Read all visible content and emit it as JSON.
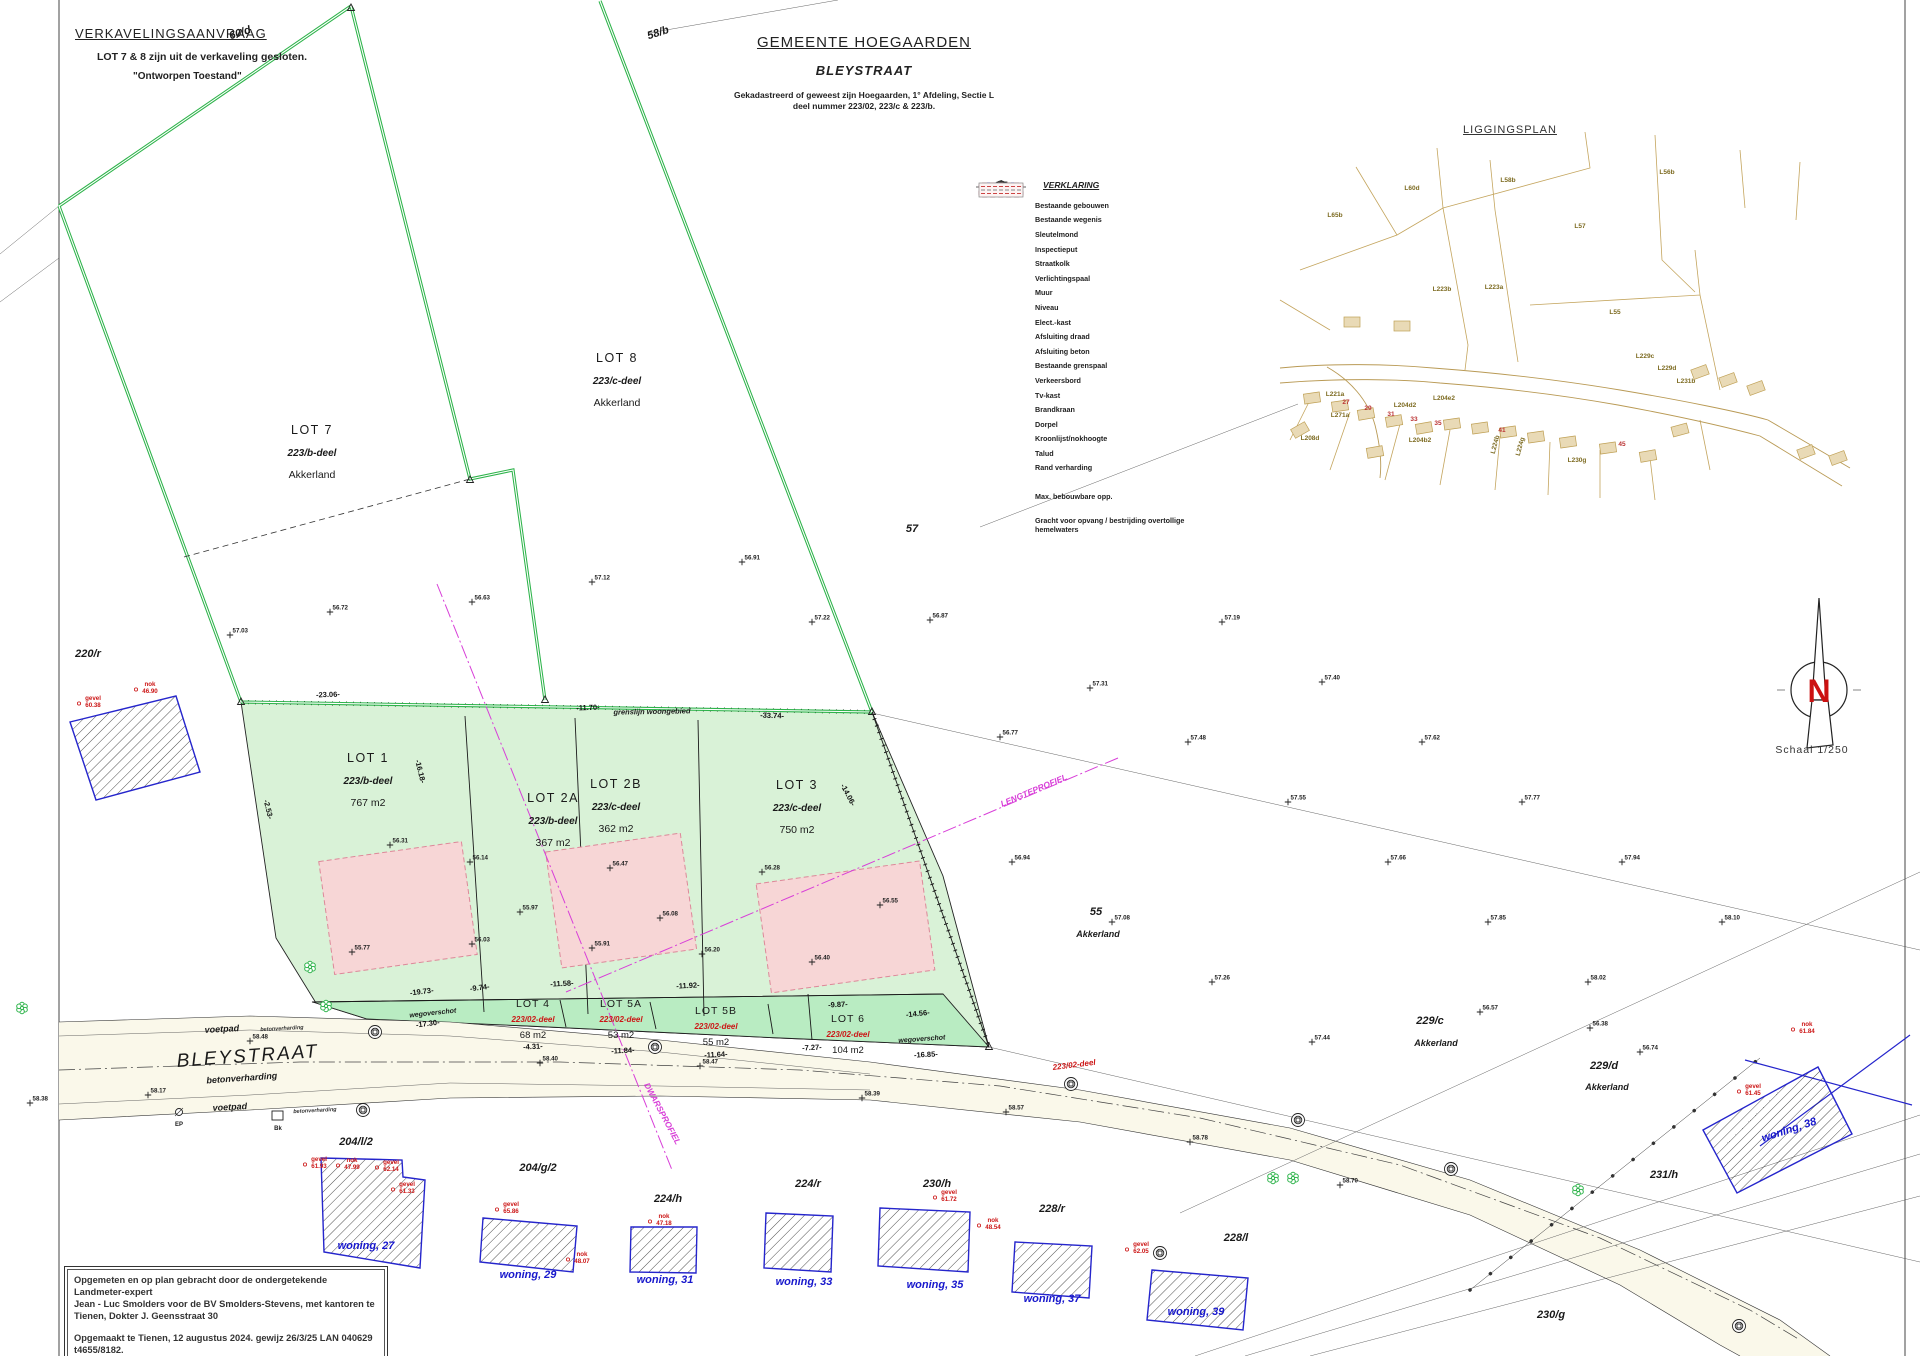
{
  "header": {
    "title": "VERKAVELINGSAANVRAAG",
    "note": "LOT 7 & 8 zijn uit de verkaveling gesloten.",
    "state": "\"Ontworpen Toestand\""
  },
  "title_block": {
    "municipality": "GEMEENTE HOEGAARDEN",
    "street": "BLEYSTRAAT",
    "cadastre1": "Gekadastreerd of geweest zijn Hoegaarden, 1° Afdeling, Sectie L",
    "cadastre2": "deel nummer 223/02, 223/c & 223/b."
  },
  "legend": {
    "title": "VERKLARING",
    "items": [
      {
        "label": "Bestaande gebouwen"
      },
      {
        "label": "Bestaande wegenis"
      },
      {
        "label": "Sleutelmond"
      },
      {
        "label": "Inspectieput"
      },
      {
        "label": "Straatkolk"
      },
      {
        "label": "Verlichtingspaal"
      },
      {
        "label": "Muur"
      },
      {
        "label": "Niveau",
        "value": "10.63"
      },
      {
        "label": "Elect.-kast"
      },
      {
        "label": "Afsluiting draad"
      },
      {
        "label": "Afsluiting beton"
      },
      {
        "label": "Bestaande grenspaal"
      },
      {
        "label": "Verkeersbord"
      },
      {
        "label": "Tv-kast"
      },
      {
        "label": "Brandkraan"
      },
      {
        "label": "Dorpel"
      },
      {
        "label": "Kroonlijst/nokhoogte"
      },
      {
        "label": "Talud"
      },
      {
        "label": "Rand verharding"
      },
      {
        "label": "Max. bebouwbare opp."
      },
      {
        "label": "Gracht voor opvang / bestrijding overtollige hemelwaters"
      }
    ]
  },
  "liggingsplan": {
    "title": "LIGGINGSPLAN",
    "labels": [
      {
        "t": "L60d",
        "x": 1412,
        "y": 190
      },
      {
        "t": "L58b",
        "x": 1508,
        "y": 182
      },
      {
        "t": "L56b",
        "x": 1667,
        "y": 174
      },
      {
        "t": "L57",
        "x": 1580,
        "y": 228
      },
      {
        "t": "L65b",
        "x": 1335,
        "y": 217
      },
      {
        "t": "L223b",
        "x": 1442,
        "y": 291
      },
      {
        "t": "L223a",
        "x": 1494,
        "y": 289
      },
      {
        "t": "L55",
        "x": 1615,
        "y": 314
      },
      {
        "t": "L229c",
        "x": 1645,
        "y": 358
      },
      {
        "t": "L229d",
        "x": 1667,
        "y": 370
      },
      {
        "t": "L231b",
        "x": 1686,
        "y": 383
      },
      {
        "t": "L221a",
        "x": 1335,
        "y": 396
      },
      {
        "t": "L271a",
        "x": 1340,
        "y": 417
      },
      {
        "t": "L204d2",
        "x": 1405,
        "y": 407
      },
      {
        "t": "L204e2",
        "x": 1444,
        "y": 400
      },
      {
        "t": "L204b2",
        "x": 1420,
        "y": 442
      },
      {
        "t": "L224b",
        "x": 1497,
        "y": 445,
        "r": -75
      },
      {
        "t": "L224g",
        "x": 1522,
        "y": 447,
        "r": -75
      },
      {
        "t": "L230g",
        "x": 1577,
        "y": 462
      },
      {
        "t": "L208d",
        "x": 1310,
        "y": 440
      },
      {
        "t": "27",
        "x": 1346,
        "y": 404,
        "cls": "lgr"
      },
      {
        "t": "29",
        "x": 1368,
        "y": 410,
        "cls": "lgr"
      },
      {
        "t": "31",
        "x": 1391,
        "y": 416,
        "cls": "lgr"
      },
      {
        "t": "33",
        "x": 1414,
        "y": 421,
        "cls": "lgr"
      },
      {
        "t": "35",
        "x": 1438,
        "y": 425,
        "cls": "lgr"
      },
      {
        "t": "41",
        "x": 1502,
        "y": 432,
        "cls": "lgr"
      },
      {
        "t": "45",
        "x": 1622,
        "y": 446,
        "cls": "lgr"
      }
    ],
    "buildings": [
      {
        "x": 1312,
        "y": 398,
        "r": -8
      },
      {
        "x": 1340,
        "y": 406,
        "r": -8
      },
      {
        "x": 1366,
        "y": 414,
        "r": -10
      },
      {
        "x": 1394,
        "y": 421,
        "r": -10
      },
      {
        "x": 1424,
        "y": 428,
        "r": -10
      },
      {
        "x": 1452,
        "y": 424,
        "r": -8
      },
      {
        "x": 1480,
        "y": 428,
        "r": -8
      },
      {
        "x": 1508,
        "y": 432,
        "r": -8
      },
      {
        "x": 1536,
        "y": 437,
        "r": -8
      },
      {
        "x": 1568,
        "y": 442,
        "r": -8
      },
      {
        "x": 1608,
        "y": 448,
        "r": -8
      },
      {
        "x": 1648,
        "y": 456,
        "r": -10
      },
      {
        "x": 1700,
        "y": 372,
        "r": -20
      },
      {
        "x": 1728,
        "y": 380,
        "r": -20
      },
      {
        "x": 1756,
        "y": 388,
        "r": -20
      },
      {
        "x": 1806,
        "y": 452,
        "r": -20
      },
      {
        "x": 1838,
        "y": 458,
        "r": -20
      },
      {
        "x": 1352,
        "y": 322,
        "r": 0
      },
      {
        "x": 1402,
        "y": 326,
        "r": 0
      },
      {
        "x": 1300,
        "y": 430,
        "r": -30
      },
      {
        "x": 1375,
        "y": 452,
        "r": -10
      },
      {
        "x": 1680,
        "y": 430,
        "r": -15
      }
    ]
  },
  "north": {
    "label": "N",
    "scale": "Schaal  1/250"
  },
  "attribution": {
    "lines": [
      "Opgemeten en op plan gebracht door de ondergetekende Landmeter-expert",
      "Jean - Luc Smolders voor de BV Smolders-Stevens, met kantoren te",
      "Tienen, Dokter J. Geensstraat 30",
      "Opgemaakt te Tienen, 12 augustus 2024. gewijz 26/3/25  LAN 040629   t4655/8182."
    ]
  },
  "map": {
    "lots_big": [
      {
        "name": "LOT 7",
        "deel": "223/b-deel",
        "info": "Akkerland",
        "x": 312,
        "y": 434
      },
      {
        "name": "LOT 8",
        "deel": "223/c-deel",
        "info": "Akkerland",
        "x": 617,
        "y": 362
      },
      {
        "name": "LOT 1",
        "deel": "223/b-deel",
        "info": "767 m2",
        "x": 368,
        "y": 762
      },
      {
        "name": "LOT 2A",
        "deel": "223/b-deel",
        "info": "367 m2",
        "x": 553,
        "y": 802
      },
      {
        "name": "LOT 2B",
        "deel": "223/c-deel",
        "info": "362 m2",
        "x": 616,
        "y": 788
      },
      {
        "name": "LOT 3",
        "deel": "223/c-deel",
        "info": "750 m2",
        "x": 797,
        "y": 789
      }
    ],
    "lots_small": [
      {
        "name": "LOT 4",
        "deel": "223/02-deel",
        "info": "68 m2",
        "x": 533,
        "y": 1007
      },
      {
        "name": "LOT 5A",
        "deel": "223/02-deel",
        "info": "53 m2",
        "x": 621,
        "y": 1007
      },
      {
        "name": "LOT 5B",
        "deel": "223/02-deel",
        "info": "55 m2",
        "x": 716,
        "y": 1014
      },
      {
        "name": "LOT 6",
        "deel": "223/02-deel",
        "info": "104 m2",
        "x": 848,
        "y": 1022
      }
    ],
    "labels": [
      {
        "t": "60/d",
        "x": 241,
        "y": 36,
        "r": -18
      },
      {
        "t": "58/b",
        "x": 659,
        "y": 36,
        "r": -18
      },
      {
        "t": "57",
        "x": 912,
        "y": 532
      },
      {
        "t": "220/r",
        "x": 88,
        "y": 657
      },
      {
        "t": "55",
        "x": 1096,
        "y": 915
      },
      {
        "t": "Akkerland",
        "x": 1098,
        "y": 937,
        "cls": "tl2"
      },
      {
        "t": "229/c",
        "x": 1430,
        "y": 1024
      },
      {
        "t": "Akkerland",
        "x": 1436,
        "y": 1046,
        "cls": "tl2"
      },
      {
        "t": "229/d",
        "x": 1604,
        "y": 1069
      },
      {
        "t": "Akkerland",
        "x": 1607,
        "y": 1090,
        "cls": "tl2"
      },
      {
        "t": "231/h",
        "x": 1664,
        "y": 1178
      },
      {
        "t": "204/l/2",
        "x": 356,
        "y": 1145
      },
      {
        "t": "204/g/2",
        "x": 538,
        "y": 1171
      },
      {
        "t": "224/h",
        "x": 668,
        "y": 1202
      },
      {
        "t": "224/r",
        "x": 808,
        "y": 1187
      },
      {
        "t": "230/h",
        "x": 937,
        "y": 1187
      },
      {
        "t": "228/r",
        "x": 1052,
        "y": 1212
      },
      {
        "t": "228/l",
        "x": 1236,
        "y": 1241
      },
      {
        "t": "230/g",
        "x": 1551,
        "y": 1318
      },
      {
        "t": "grenslijn woongebied",
        "x": 652,
        "y": 714,
        "r": -1,
        "cls": "tlsm"
      },
      {
        "t": "wegoverschot",
        "x": 433,
        "y": 1015,
        "r": -6,
        "cls": "wov"
      },
      {
        "t": "wegoverschot",
        "x": 922,
        "y": 1041,
        "r": -4,
        "cls": "wov"
      },
      {
        "t": "voetpad",
        "x": 222,
        "y": 1032,
        "r": -3,
        "cls": "st2"
      },
      {
        "t": "BLEYSTRAAT",
        "x": 248,
        "y": 1062,
        "r": -4,
        "cls": "stbig"
      },
      {
        "t": "betonverharding",
        "x": 242,
        "y": 1081,
        "r": -4,
        "cls": "st2"
      },
      {
        "t": "voetpad",
        "x": 230,
        "y": 1110,
        "r": -3,
        "cls": "st2"
      },
      {
        "t": "betonverharding",
        "x": 282,
        "y": 1030,
        "r": -3,
        "cls": "stxs"
      },
      {
        "t": "betonverharding",
        "x": 315,
        "y": 1112,
        "r": -3,
        "cls": "stxs"
      },
      {
        "t": "Bk",
        "x": 278,
        "y": 1130,
        "cls": "tlxs"
      },
      {
        "t": "EP",
        "x": 179,
        "y": 1126,
        "cls": "tlxs"
      },
      {
        "t": "woning, 27",
        "x": 366,
        "y": 1249,
        "cls": "blue"
      },
      {
        "t": "woning, 29",
        "x": 528,
        "y": 1278,
        "cls": "blue"
      },
      {
        "t": "woning, 31",
        "x": 665,
        "y": 1283,
        "cls": "blue"
      },
      {
        "t": "woning, 33",
        "x": 804,
        "y": 1285,
        "cls": "blue"
      },
      {
        "t": "woning, 35",
        "x": 935,
        "y": 1288,
        "cls": "blue"
      },
      {
        "t": "woning, 37",
        "x": 1052,
        "y": 1302,
        "cls": "blue"
      },
      {
        "t": "woning, 39",
        "x": 1196,
        "y": 1315,
        "cls": "blue"
      },
      {
        "t": "woning, 38",
        "x": 1790,
        "y": 1133,
        "r": -18,
        "cls": "blue"
      }
    ],
    "measurements": [
      {
        "t": "-23.06-",
        "x": 328,
        "y": 697,
        "r": -2
      },
      {
        "t": "-11.70-",
        "x": 588,
        "y": 710,
        "r": -2
      },
      {
        "t": "-33.74-",
        "x": 772,
        "y": 718,
        "r": 2
      },
      {
        "t": "-19.73-",
        "x": 422,
        "y": 994,
        "r": -7
      },
      {
        "t": "-9.74-",
        "x": 480,
        "y": 990,
        "r": -7
      },
      {
        "t": "-11.58-",
        "x": 562,
        "y": 986,
        "r": -3
      },
      {
        "t": "-11.92-",
        "x": 688,
        "y": 988,
        "r": -3
      },
      {
        "t": "-4.31-",
        "x": 533,
        "y": 1049,
        "r": -3
      },
      {
        "t": "-11.84-",
        "x": 623,
        "y": 1053,
        "r": -3
      },
      {
        "t": "-11.64-",
        "x": 716,
        "y": 1057,
        "r": -3
      },
      {
        "t": "-14.56-",
        "x": 918,
        "y": 1016,
        "r": -6
      },
      {
        "t": "-7.27-",
        "x": 812,
        "y": 1050,
        "r": -3
      },
      {
        "t": "-16.85-",
        "x": 926,
        "y": 1057,
        "r": -3
      },
      {
        "t": "-17.30-",
        "x": 428,
        "y": 1026,
        "r": -7
      },
      {
        "t": "-9.87-",
        "x": 838,
        "y": 1007,
        "r": -3
      },
      {
        "t": "-16.18-",
        "x": 418,
        "y": 772,
        "r": 76
      },
      {
        "t": "-14.06-",
        "x": 846,
        "y": 796,
        "r": 62
      },
      {
        "t": "-2.53-",
        "x": 266,
        "y": 810,
        "r": 76
      }
    ],
    "profiles": [
      {
        "t": "DWARSPROFIEL",
        "x": 660,
        "y": 1115,
        "r": 62
      },
      {
        "t": "LENGTEPROFIEL",
        "x": 1035,
        "y": 793,
        "r": -23
      }
    ],
    "spot_heights": [
      {
        "v": "56.31",
        "x": 390,
        "y": 845
      },
      {
        "v": "56.14",
        "x": 470,
        "y": 862
      },
      {
        "v": "56.47",
        "x": 610,
        "y": 868
      },
      {
        "v": "56.28",
        "x": 762,
        "y": 872
      },
      {
        "v": "55.97",
        "x": 520,
        "y": 912
      },
      {
        "v": "56.08",
        "x": 660,
        "y": 918
      },
      {
        "v": "55.77",
        "x": 352,
        "y": 952
      },
      {
        "v": "56.03",
        "x": 472,
        "y": 944
      },
      {
        "v": "55.91",
        "x": 592,
        "y": 948
      },
      {
        "v": "56.20",
        "x": 702,
        "y": 954
      },
      {
        "v": "56.40",
        "x": 812,
        "y": 962
      },
      {
        "v": "56.55",
        "x": 880,
        "y": 905
      },
      {
        "v": "56.87",
        "x": 930,
        "y": 620
      },
      {
        "v": "57.03",
        "x": 230,
        "y": 635
      },
      {
        "v": "56.72",
        "x": 330,
        "y": 612
      },
      {
        "v": "56.63",
        "x": 472,
        "y": 602
      },
      {
        "v": "57.12",
        "x": 592,
        "y": 582
      },
      {
        "v": "56.91",
        "x": 742,
        "y": 562
      },
      {
        "v": "57.22",
        "x": 812,
        "y": 622
      },
      {
        "v": "56.77",
        "x": 1000,
        "y": 737
      },
      {
        "v": "57.31",
        "x": 1090,
        "y": 688
      },
      {
        "v": "57.48",
        "x": 1188,
        "y": 742
      },
      {
        "v": "57.55",
        "x": 1288,
        "y": 802
      },
      {
        "v": "57.66",
        "x": 1388,
        "y": 862
      },
      {
        "v": "57.85",
        "x": 1488,
        "y": 922
      },
      {
        "v": "58.02",
        "x": 1588,
        "y": 982
      },
      {
        "v": "57.19",
        "x": 1222,
        "y": 622
      },
      {
        "v": "57.40",
        "x": 1322,
        "y": 682
      },
      {
        "v": "57.62",
        "x": 1422,
        "y": 742
      },
      {
        "v": "57.77",
        "x": 1522,
        "y": 802
      },
      {
        "v": "57.94",
        "x": 1622,
        "y": 862
      },
      {
        "v": "58.10",
        "x": 1722,
        "y": 922
      },
      {
        "v": "56.94",
        "x": 1012,
        "y": 862
      },
      {
        "v": "57.08",
        "x": 1112,
        "y": 922
      },
      {
        "v": "57.26",
        "x": 1212,
        "y": 982
      },
      {
        "v": "57.44",
        "x": 1312,
        "y": 1042
      },
      {
        "v": "58.48",
        "x": 250,
        "y": 1041
      },
      {
        "v": "58.17",
        "x": 148,
        "y": 1095
      },
      {
        "v": "58.38",
        "x": 30,
        "y": 1103
      },
      {
        "v": "58.40",
        "x": 540,
        "y": 1063
      },
      {
        "v": "58.47",
        "x": 700,
        "y": 1066
      },
      {
        "v": "58.39",
        "x": 862,
        "y": 1098
      },
      {
        "v": "58.57",
        "x": 1006,
        "y": 1112
      },
      {
        "v": "58.78",
        "x": 1190,
        "y": 1142
      },
      {
        "v": "58.70",
        "x": 1340,
        "y": 1185
      },
      {
        "v": "56.38",
        "x": 1590,
        "y": 1028
      },
      {
        "v": "56.74",
        "x": 1640,
        "y": 1052
      },
      {
        "v": "56.57",
        "x": 1480,
        "y": 1012
      }
    ],
    "red_labels": [
      {
        "t1": "gevel",
        "t2": "61.93",
        "x": 319,
        "y": 1161
      },
      {
        "t1": "nok",
        "t2": "47.99",
        "x": 352,
        "y": 1162
      },
      {
        "t1": "gevel",
        "t2": "62.14",
        "x": 391,
        "y": 1164
      },
      {
        "t1": "gevel",
        "t2": "61.33",
        "x": 407,
        "y": 1186
      },
      {
        "t1": "gevel",
        "t2": "65.86",
        "x": 511,
        "y": 1206
      },
      {
        "t1": "nok",
        "t2": "47.18",
        "x": 664,
        "y": 1218
      },
      {
        "t1": "nok",
        "t2": "48.07",
        "x": 582,
        "y": 1256
      },
      {
        "t1": "gevel",
        "t2": "61.72",
        "x": 949,
        "y": 1194
      },
      {
        "t1": "nok",
        "t2": "48.54",
        "x": 993,
        "y": 1222
      },
      {
        "t1": "gevel",
        "t2": "62.05",
        "x": 1141,
        "y": 1246
      },
      {
        "t1": "gevel",
        "t2": "61.45",
        "x": 1753,
        "y": 1088
      },
      {
        "t1": "nok",
        "t2": "61.84",
        "x": 1807,
        "y": 1026
      },
      {
        "t1": "gevel",
        "t2": "60.38",
        "x": 93,
        "y": 700
      },
      {
        "t1": "nok",
        "t2": "46.90",
        "x": 150,
        "y": 686
      }
    ],
    "red_italic": [
      {
        "t1": "223/02-deel",
        "x": 1053,
        "y": 1070,
        "r": -7
      }
    ],
    "houses": [
      {
        "pts": "321,1158 402,1160 403,1177 425,1180 420,1268 324,1252"
      },
      {
        "pts": "483,1218 577,1226 573,1272 480,1262"
      },
      {
        "pts": "631,1227 697,1227 696,1273 630,1272"
      },
      {
        "pts": "766,1213 833,1216 831,1272 764,1268"
      },
      {
        "pts": "880,1208 970,1212 968,1272 878,1266"
      },
      {
        "pts": "1015,1242 1092,1246 1089,1298 1012,1292"
      },
      {
        "pts": "1152,1270 1248,1278 1243,1330 1147,1320"
      },
      {
        "pts": "1703,1130 1818,1067 1852,1134 1737,1193"
      },
      {
        "pts": "70,722 176,696 200,772 96,800"
      }
    ],
    "trees": [
      {
        "x": 310,
        "y": 967
      },
      {
        "x": 326,
        "y": 1006
      },
      {
        "x": 1273,
        "y": 1178
      },
      {
        "x": 1293,
        "y": 1178
      },
      {
        "x": 1578,
        "y": 1190
      },
      {
        "x": 22,
        "y": 1008
      }
    ],
    "putten": [
      {
        "x": 375,
        "y": 1032
      },
      {
        "x": 655,
        "y": 1047
      },
      {
        "x": 1071,
        "y": 1084
      },
      {
        "x": 1298,
        "y": 1120
      },
      {
        "x": 1451,
        "y": 1169
      },
      {
        "x": 363,
        "y": 1110
      },
      {
        "x": 1160,
        "y": 1253
      },
      {
        "x": 1739,
        "y": 1326
      }
    ],
    "palen": [
      {
        "x": 241,
        "y": 702
      },
      {
        "x": 470,
        "y": 480
      },
      {
        "x": 545,
        "y": 700
      },
      {
        "x": 872,
        "y": 712
      },
      {
        "x": 989,
        "y": 1047
      },
      {
        "x": 351,
        "y": 8
      }
    ]
  }
}
